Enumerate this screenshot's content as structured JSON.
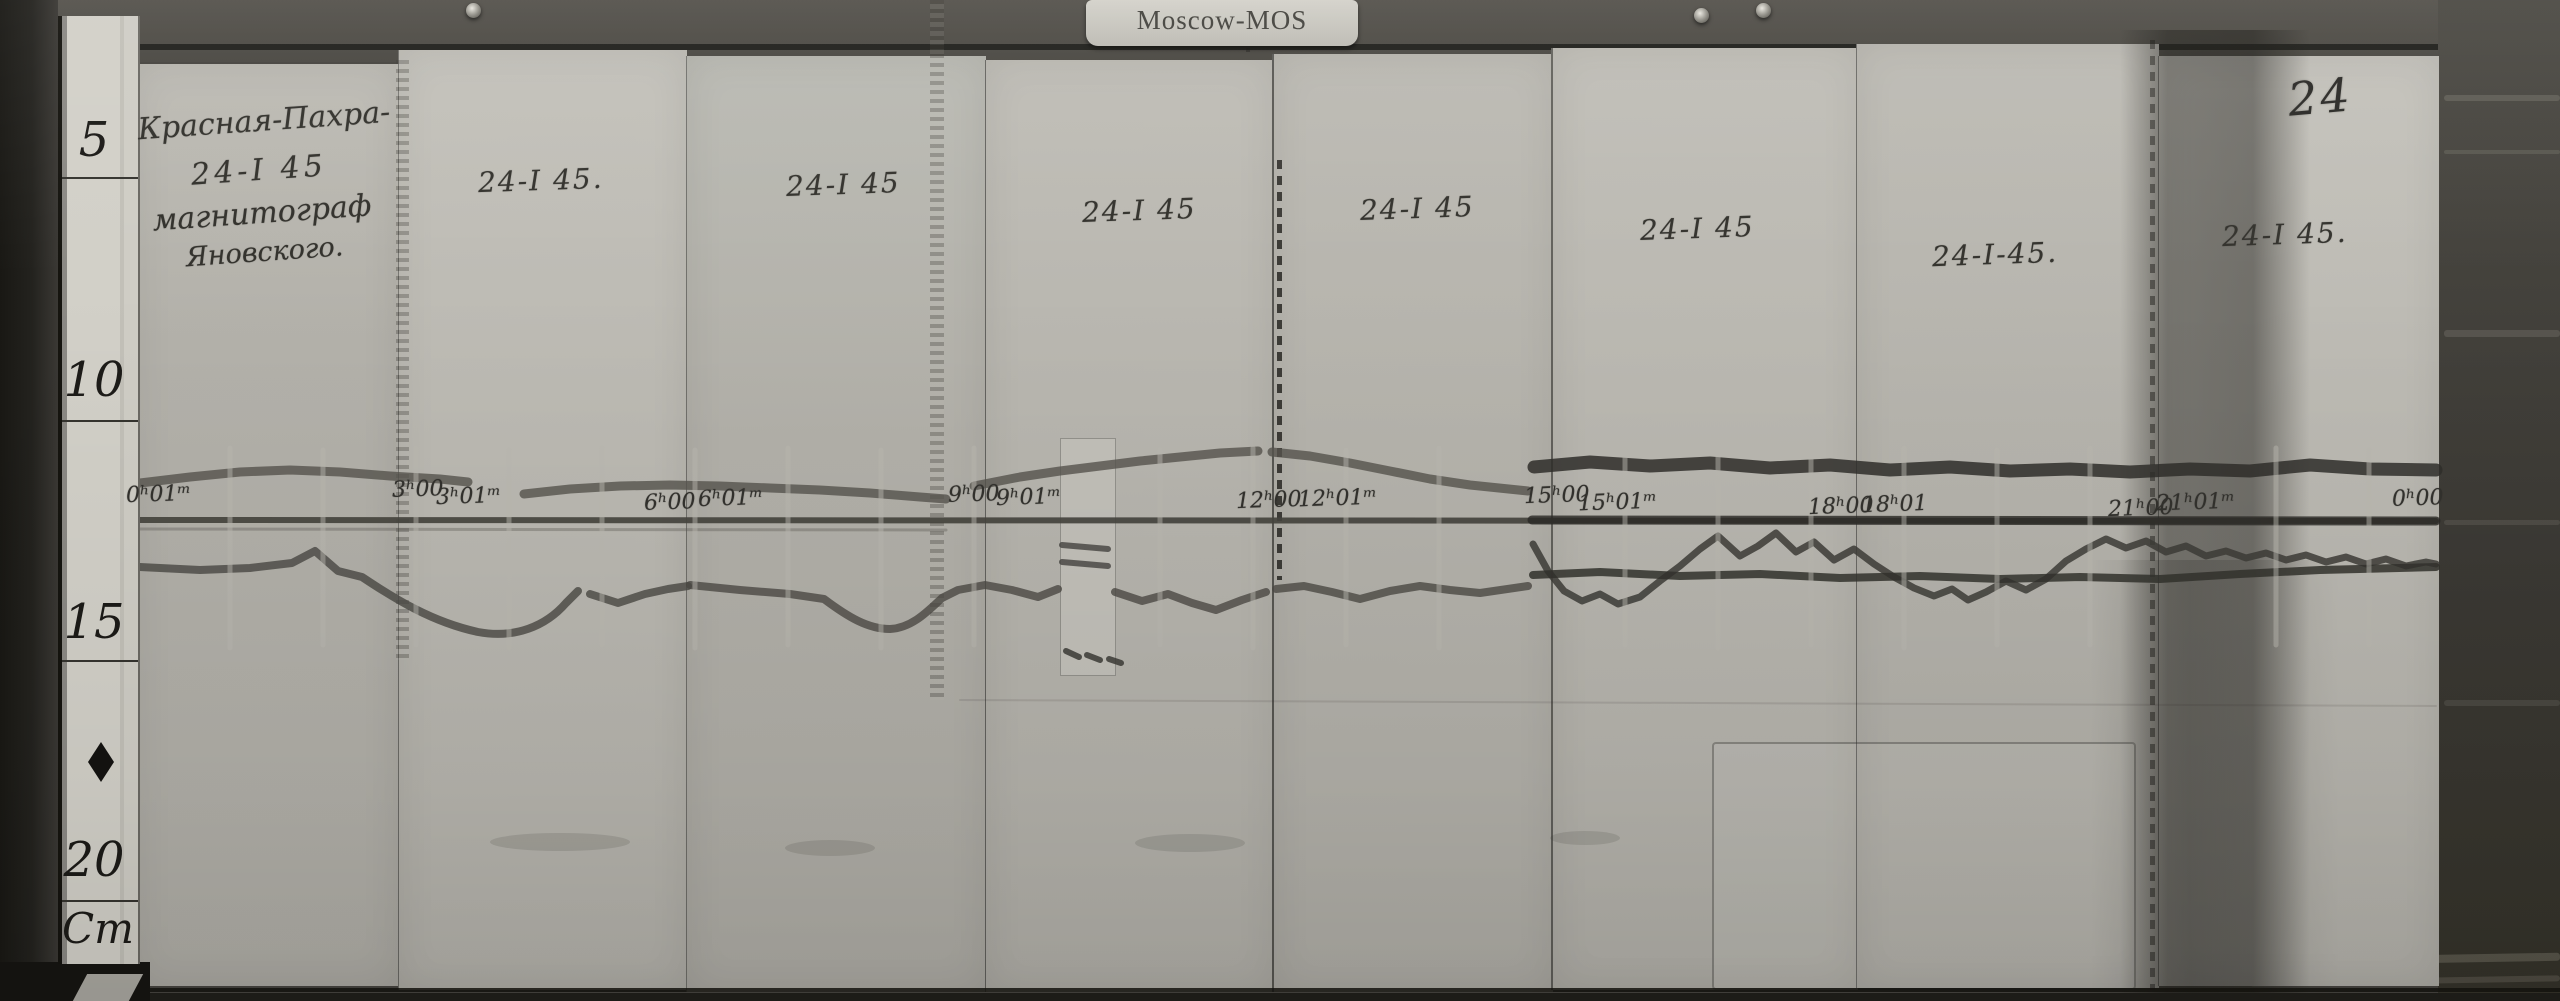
{
  "archive_tag": "Moscow-MOS",
  "sheet_number": "24",
  "station_annotation": {
    "line1": "Красная-Пахра-",
    "line2": "24-I 45",
    "line3": "магнитограф",
    "line4": "Яновского."
  },
  "strip_date_labels": [
    "24-I 45.",
    "24-I 45",
    "24-I 45",
    "24-I 45",
    "24-I 45",
    "24-I-45.",
    "24-I 45."
  ],
  "ruler": {
    "marks": [
      "5",
      "10",
      "15",
      "20"
    ],
    "unit": "Cm"
  },
  "time_marks": [
    "0ʰ01ᵐ",
    "3ʰ00",
    "3ʰ01ᵐ",
    "6ʰ00",
    "6ʰ01ᵐ",
    "9ʰ00",
    "9ʰ01ᵐ",
    "12ʰ00",
    "12ʰ01ᵐ",
    "15ʰ00",
    "15ʰ01ᵐ",
    "18ʰ00",
    "18ʰ01",
    "21ʰ00",
    "21ʰ01ᵐ",
    "0ʰ00"
  ],
  "icons": {
    "ruler_diamond": "diamond-mark"
  },
  "colors": {
    "wood": "#46443f",
    "paper_strip": "#b6b4ad",
    "ruler_paper": "#d2d0c8",
    "tag_paper": "#cccac2",
    "ink": "#35342f",
    "trace": "#2f2e2a"
  }
}
